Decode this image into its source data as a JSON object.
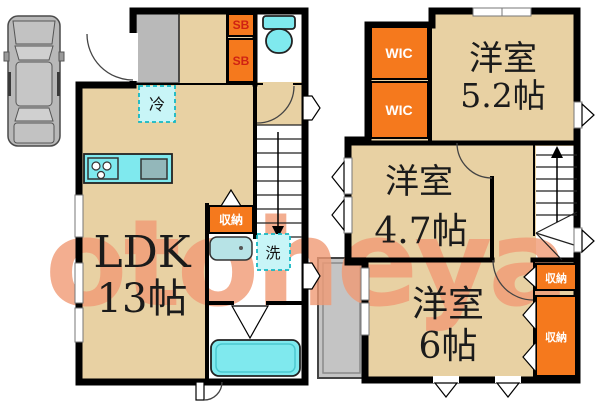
{
  "watermark": "otoheya",
  "colors": {
    "floor_beige": "#e8d1a3",
    "storage_orange": "#f5791d",
    "fixture_cyan": "#7fe9ee",
    "fixture_cyan_light": "#c8f5f7",
    "parking_gray": "#b9b9b9",
    "wall_black": "#000000",
    "watermark_salmon": "#f09a74"
  },
  "floor1": {
    "ldk_line1": "LDK",
    "ldk_line2": "13帖",
    "fridge_label": "冷",
    "storage_label": "収納",
    "laundry_label": "洗",
    "shoebox_top": "SB",
    "shoebox_bottom": "SB"
  },
  "floor2": {
    "wic_top": "WIC",
    "wic_bottom": "WIC",
    "room52_line1": "洋室",
    "room52_line2": "5.2帖",
    "room47_line1": "洋室",
    "room47_line2": "4.7帖",
    "room6_line1": "洋室",
    "room6_line2": "6帖",
    "storage_small": "収納",
    "storage_large": "収納"
  }
}
